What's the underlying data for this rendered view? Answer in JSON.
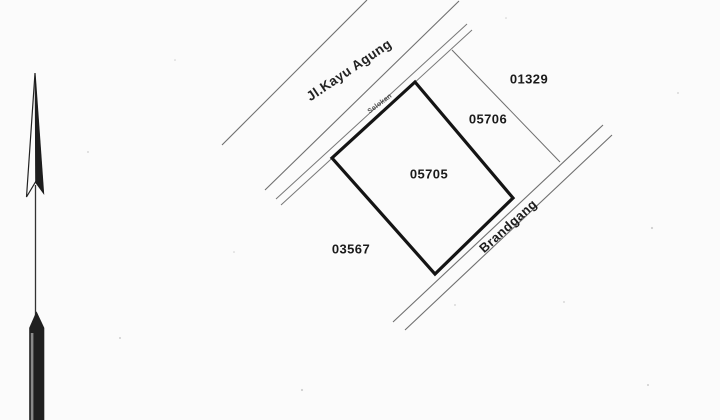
{
  "document": {
    "type_label": "cadastral parcel survey map",
    "labels": {
      "road": "Jl.Kayu Agung",
      "ditch": "Selokan",
      "alley": "Brandgang"
    },
    "parcels": {
      "main": "05705",
      "north_neighbor": "01329",
      "east_neighbor": "05706",
      "southwest_neighbor": "03567"
    },
    "icons": {
      "north_arrow": "north-arrow"
    },
    "colors": {
      "background": "#fbfbfb",
      "thin_line": "#6f6f6f",
      "bold_line": "#141414",
      "text": "#1a1a1a"
    }
  }
}
